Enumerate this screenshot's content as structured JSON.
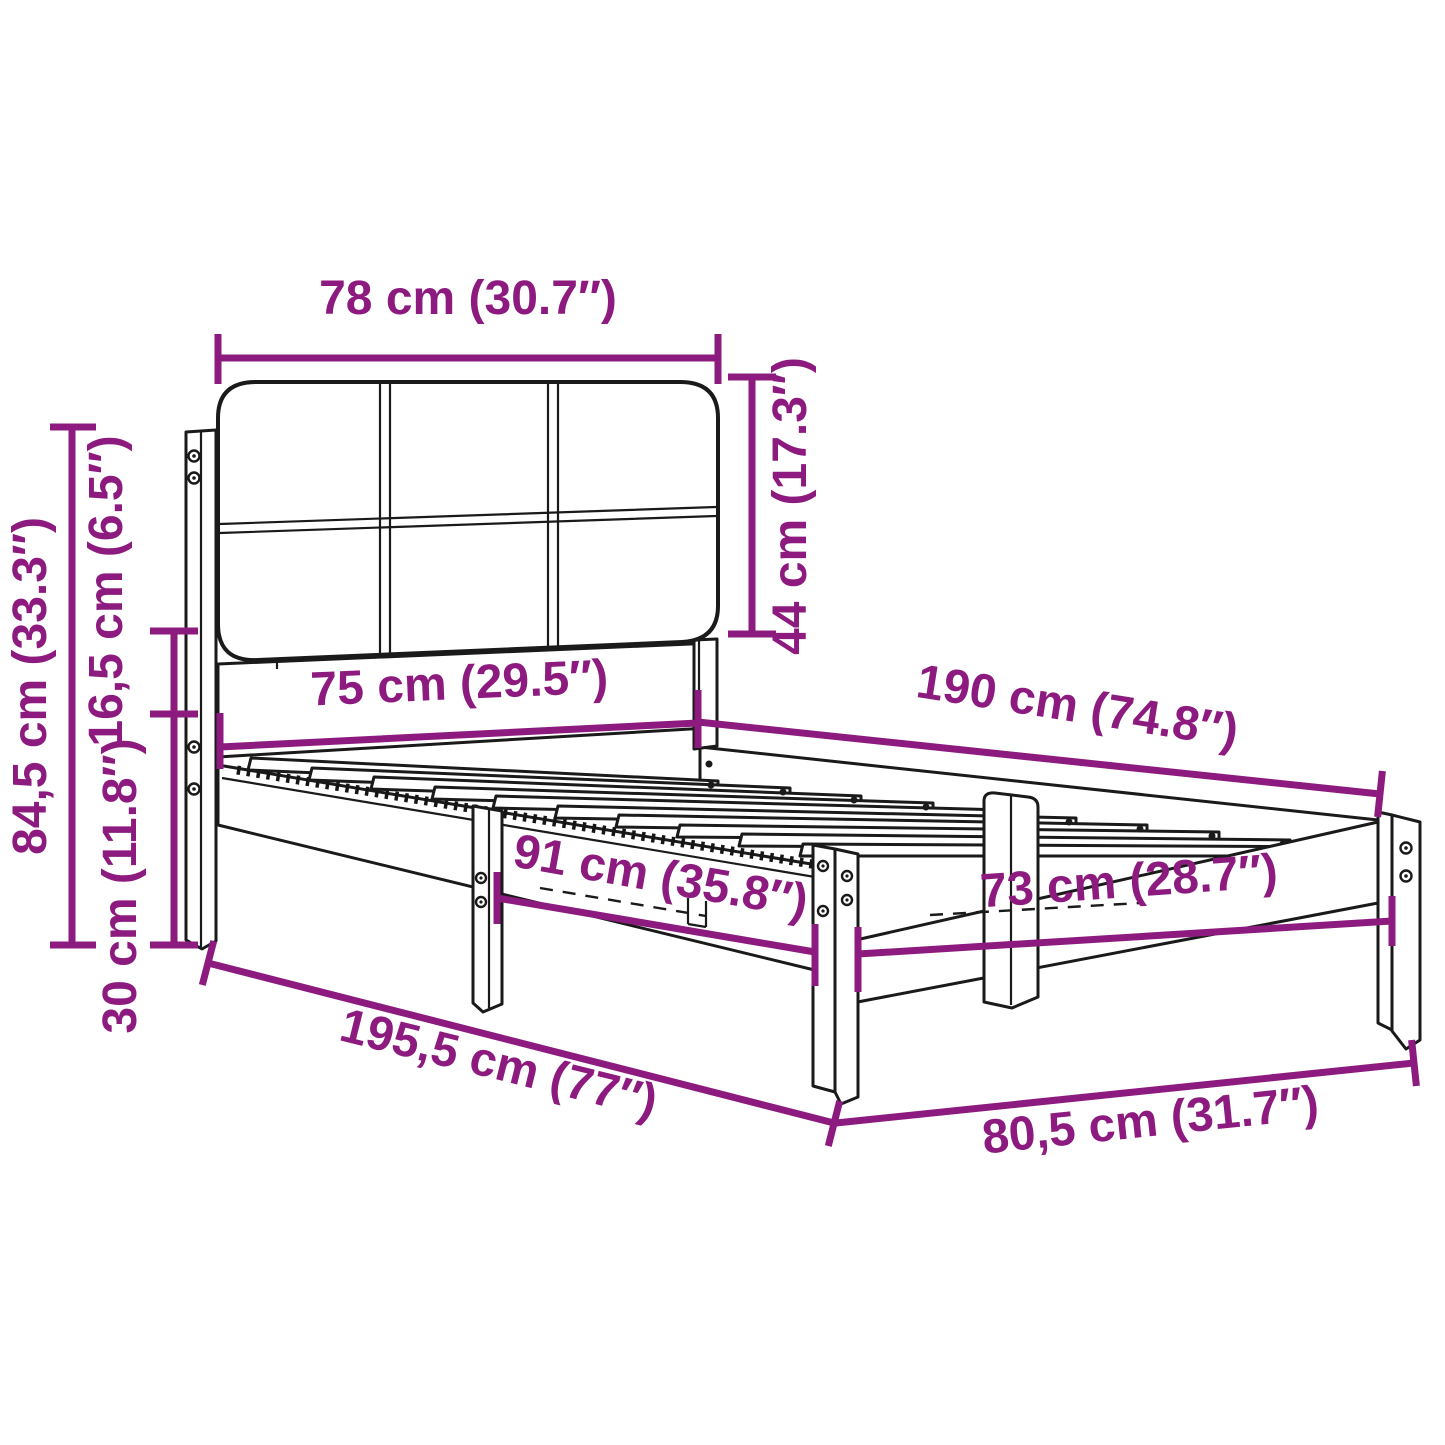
{
  "diagram": {
    "type": "furniture-dimension-diagram",
    "subject": "bed frame with upholstered headboard",
    "background_color": "#ffffff",
    "dimension_color": "#8D1B7F",
    "line_art_color": "#1a1a1a",
    "dimensions": {
      "headboard_width": {
        "text": "78 cm (30.7″)",
        "cm": "78",
        "inches": "30.7"
      },
      "headboard_height": {
        "text": "44 cm (17.3″)",
        "cm": "44",
        "inches": "17.3"
      },
      "overall_height": {
        "text": "84,5 cm (33.3″)",
        "cm": "84,5",
        "inches": "33.3"
      },
      "headboard_offset": {
        "text": "16,5 cm (6.5″)",
        "cm": "16,5",
        "inches": "6.5"
      },
      "frame_height": {
        "text": "30 cm (11.8″)",
        "cm": "30",
        "inches": "11.8"
      },
      "headboard_inner_width": {
        "text": "75 cm (29.5″)",
        "cm": "75",
        "inches": "29.5"
      },
      "mattress_length": {
        "text": "190 cm (74.8″)",
        "cm": "190",
        "inches": "74.8"
      },
      "leg_spacing": {
        "text": "91 cm (35.8″)",
        "cm": "91",
        "inches": "35.8"
      },
      "foot_inner_width": {
        "text": "73 cm (28.7″)",
        "cm": "73",
        "inches": "28.7"
      },
      "overall_length": {
        "text": "195,5 cm (77″)",
        "cm": "195,5",
        "inches": "77"
      },
      "overall_width": {
        "text": "80,5 cm (31.7″)",
        "cm": "80,5",
        "inches": "31.7"
      }
    }
  }
}
